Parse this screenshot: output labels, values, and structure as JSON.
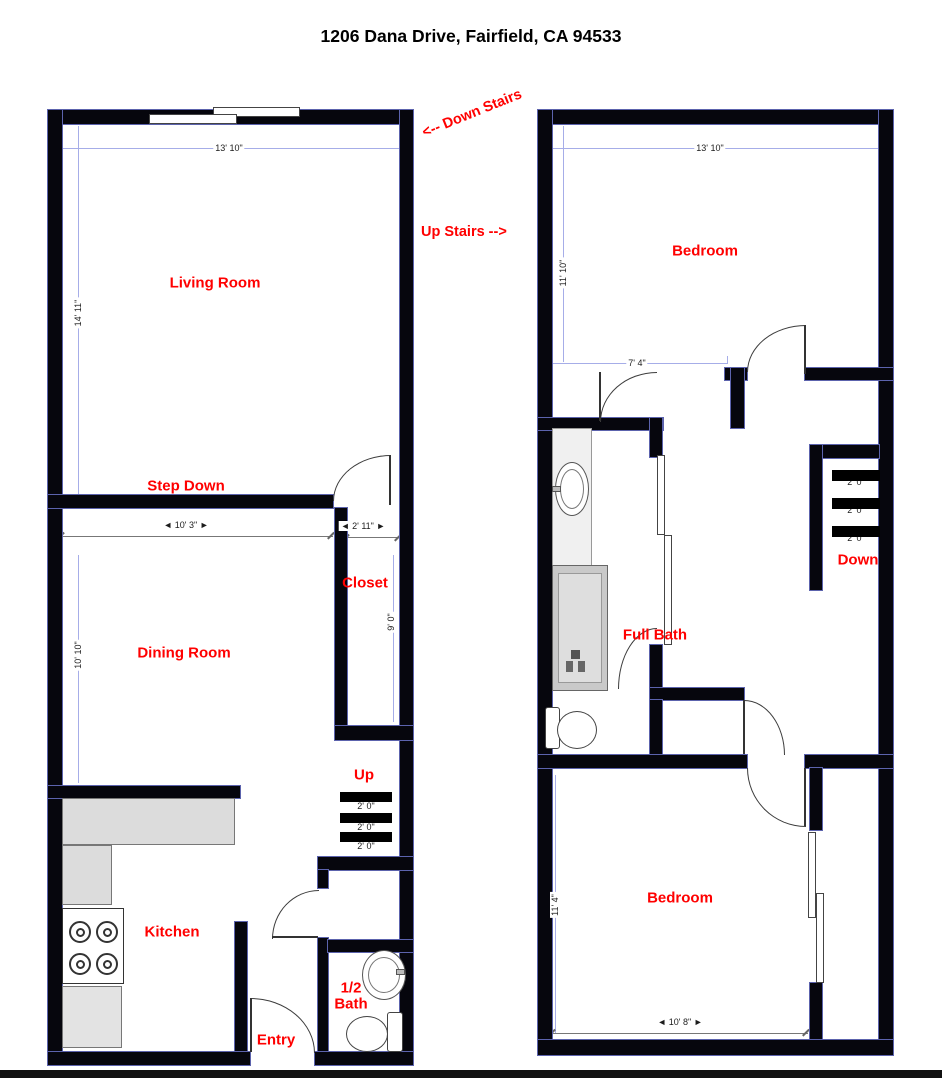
{
  "title": "1206 Dana Drive, Fairfield, CA 94533",
  "annotations": {
    "down_stairs": "<-- Down Stairs",
    "up_stairs": "Up Stairs -->"
  },
  "floor1": {
    "living_room": {
      "label": "Living Room",
      "width": "13' 10\"",
      "height": "14' 11\""
    },
    "step_down": {
      "label": "Step Down",
      "hidden_width": "14' 6\""
    },
    "dining_room": {
      "label": "Dining Room",
      "width": "◄ 10' 3\" ►",
      "height": "10' 10\""
    },
    "closet": {
      "label": "Closet",
      "width": "◄ 2' 11\" ►",
      "height": "9' 0\""
    },
    "stairs": {
      "label": "Up",
      "tread_depth": "2' 0\""
    },
    "kitchen": {
      "label": "Kitchen"
    },
    "entry": {
      "label": "Entry"
    },
    "half_bath": {
      "label": "1/2 Bath"
    }
  },
  "floor2": {
    "bedroom_front": {
      "label": "Bedroom",
      "width": "13' 10\"",
      "height": "11' 10\""
    },
    "hall": {
      "width": "7' 4\""
    },
    "full_bath": {
      "label": "Full Bath"
    },
    "stairs": {
      "label": "Down",
      "tread_depth": "2' 0\""
    },
    "bedroom_back": {
      "label": "Bedroom",
      "width": "◄ 10' 8\" ►",
      "height": "11' 4\""
    }
  },
  "colors": {
    "room_label": "#FF0000",
    "wall": "#000000",
    "wall_trim": "#5C63AD",
    "dimension_line": "#A6ADE8",
    "counter_fill": "#DCDCDC",
    "tub_fill": "#C9C9C9"
  }
}
